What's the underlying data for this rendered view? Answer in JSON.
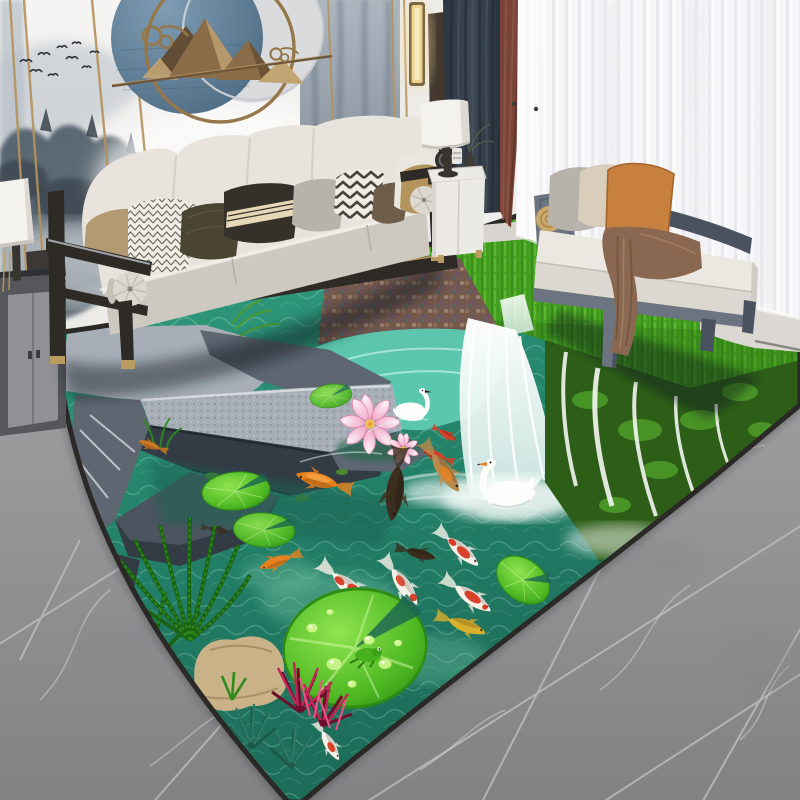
{
  "meta": {
    "kind": "product-photograph",
    "description": "Modern living room staged with a 3D-print koi pond waterfall area rug on gray marble tile; cream sofa with patterned pillows, misty mountain mural with circular bronze wall sculpture, navy/maroon/sheer curtains, white daybed bench with orange pillow and brown throw"
  },
  "palette": {
    "wall": "#f3f2ef",
    "wallShade": "#e7e5e2",
    "muralLight": "#b6bec7",
    "muralMid": "#8d98a4",
    "muralTree": "#4e5c68",
    "muralDeep": "#39434e",
    "gold": "#b5925c",
    "artBlue": "#64839e",
    "artBlueDeep": "#486780",
    "artSilver": "#d9dbdd",
    "artRing": "#96774a",
    "bronze": "#8a6c48",
    "bronzeLight": "#c2a473",
    "bronzeDark": "#61492f",
    "navy": "#38424e",
    "navyDeep": "#252e38",
    "maroon": "#7a4538",
    "sheer": "#f7f7f9",
    "sheerShade": "#e9e9ed",
    "sconce": "#eed28e",
    "sill": "#d8d5d0",
    "marble": "#9c9c9e",
    "marbleDark": "#86868a",
    "grout": "#b9b9bb",
    "vein": "#cdcdcf",
    "rugEdge": "#2b2925",
    "water": "#2c8c72",
    "waterDeep": "#1b6453",
    "aqua": "#5ecab2",
    "caustic": "#bdf2dc",
    "sand": "#74c4a4",
    "rockTop": "#a7aeb8",
    "rock": "#5d6671",
    "rockDark": "#333b45",
    "rockVein": "#dde0e4",
    "grass": "#46a322",
    "grassDark": "#2a7012",
    "grassLight": "#79d338",
    "moss": "#2d5e18",
    "mossLight": "#4d9a28",
    "pebble": "#75594b",
    "fallWhite": "#ffffff",
    "mist": "#e8f4f1",
    "pad": "#3fae1c",
    "padLight": "#86df46",
    "padDark": "#27800f",
    "lotus": "#f3aecb",
    "lotusDeep": "#e27fa9",
    "lotusPale": "#fcebf3",
    "swan": "#fdfdfc",
    "swanShade": "#c7d1d6",
    "beak": "#e0862a",
    "koiOrange": "#e8821e",
    "koiRed": "#d84028",
    "koiWhite": "#f6f1e8",
    "koiYellow": "#d9b02c",
    "koiDark": "#3b2e1f",
    "koiBrown": "#b98a4e",
    "palm": "#2f8c1c",
    "palmDark": "#1c6210",
    "pineTeal": "#2f7a66",
    "pineTealDark": "#1d5a49",
    "magenta": "#c22656",
    "magentaDark": "#6d0f2a",
    "pinkPlant": "#e8558a",
    "tanRock": "#c9b188",
    "tanRockDark": "#9b8159",
    "sofa": "#e8e4dd",
    "sofaShade": "#cdc8c0",
    "sofaDeep": "#b4afa6",
    "frame": "#2e2a26",
    "brass": "#bb9c60",
    "pTan": "#b49a72",
    "pChevLight": "#efece4",
    "pOlive": "#4a4433",
    "pBlack": "#35302a",
    "pBand": "#e6d7b6",
    "pGray": "#b7b3ab",
    "pBrown": "#6e5d49",
    "pCream": "#eae7e0",
    "pGold": "#b2945c",
    "chevInk": "#3e3b35",
    "bench": "#6b7480",
    "benchDark": "#49525e",
    "benchCushion": "#ebe8e1",
    "pBeige": "#d9cdbc",
    "pOrange": "#c8803e",
    "throw": "#8a6750",
    "throwDark": "#6d4f3b",
    "throwLight": "#a88462",
    "table": "#eceae5",
    "lampShade": "#f4f2ed",
    "lampDark": "#38342f",
    "cab": "#55575a",
    "cabPanel": "#8f9194",
    "cabTop": "#2e3032",
    "shadow": "#10161a"
  },
  "scene": {
    "wall": {
      "mural": "misty mountains with pine trees",
      "birds": 11,
      "trim": "gold vertical strips",
      "art": "overlapping blue + silver discs, gold rings, bronze mountain silhouettes on a rod with cloud curls"
    },
    "window": {
      "curtains": [
        "navy panel",
        "maroon panel",
        "white sheer"
      ],
      "sconce": "warm vertical bar light"
    },
    "furniture": {
      "sofa": {
        "pillows": [
          "khaki",
          "white thin chevron",
          "dark olive textured",
          "black with cream striped band",
          "warm gray",
          "white bold chevron",
          "dark brown",
          "cream",
          "gold"
        ],
        "bolsters": 2,
        "frame": "espresso wood with brass feet"
      },
      "side_cabinet": "charcoal with light panels",
      "floor_lamp": "white drum shade",
      "side_table": {
        "finish": "white",
        "decor": [
          "black disc",
          "spool",
          "dark vase",
          "branches"
        ],
        "lamp": "white cylinder shade, dark base"
      },
      "bench": {
        "cushion": "white",
        "pillows": [
          "gray",
          "beige",
          "orange"
        ],
        "throw": "brown",
        "bolster": "wood cylinder"
      }
    },
    "floor": {
      "material": "gray marble tile",
      "grout": "diagonal",
      "veins": "white"
    },
    "rug": {
      "theme": "3D koi pond with waterfall",
      "slate_rocks": true,
      "waterfalls": 2,
      "swans": 2,
      "lotus_blooms": 2,
      "lily_pads": 5,
      "koi_count": 15,
      "koi_colors": [
        "orange",
        "red-white kohaku",
        "dark brown",
        "yellow",
        "brown"
      ],
      "plants": [
        "palm fronds",
        "teal pine tufts",
        "magenta plants",
        "green sprouts"
      ],
      "tan_rock": true,
      "frog_on_pad": true,
      "water_droplets": 7,
      "border": "dark edge"
    }
  }
}
